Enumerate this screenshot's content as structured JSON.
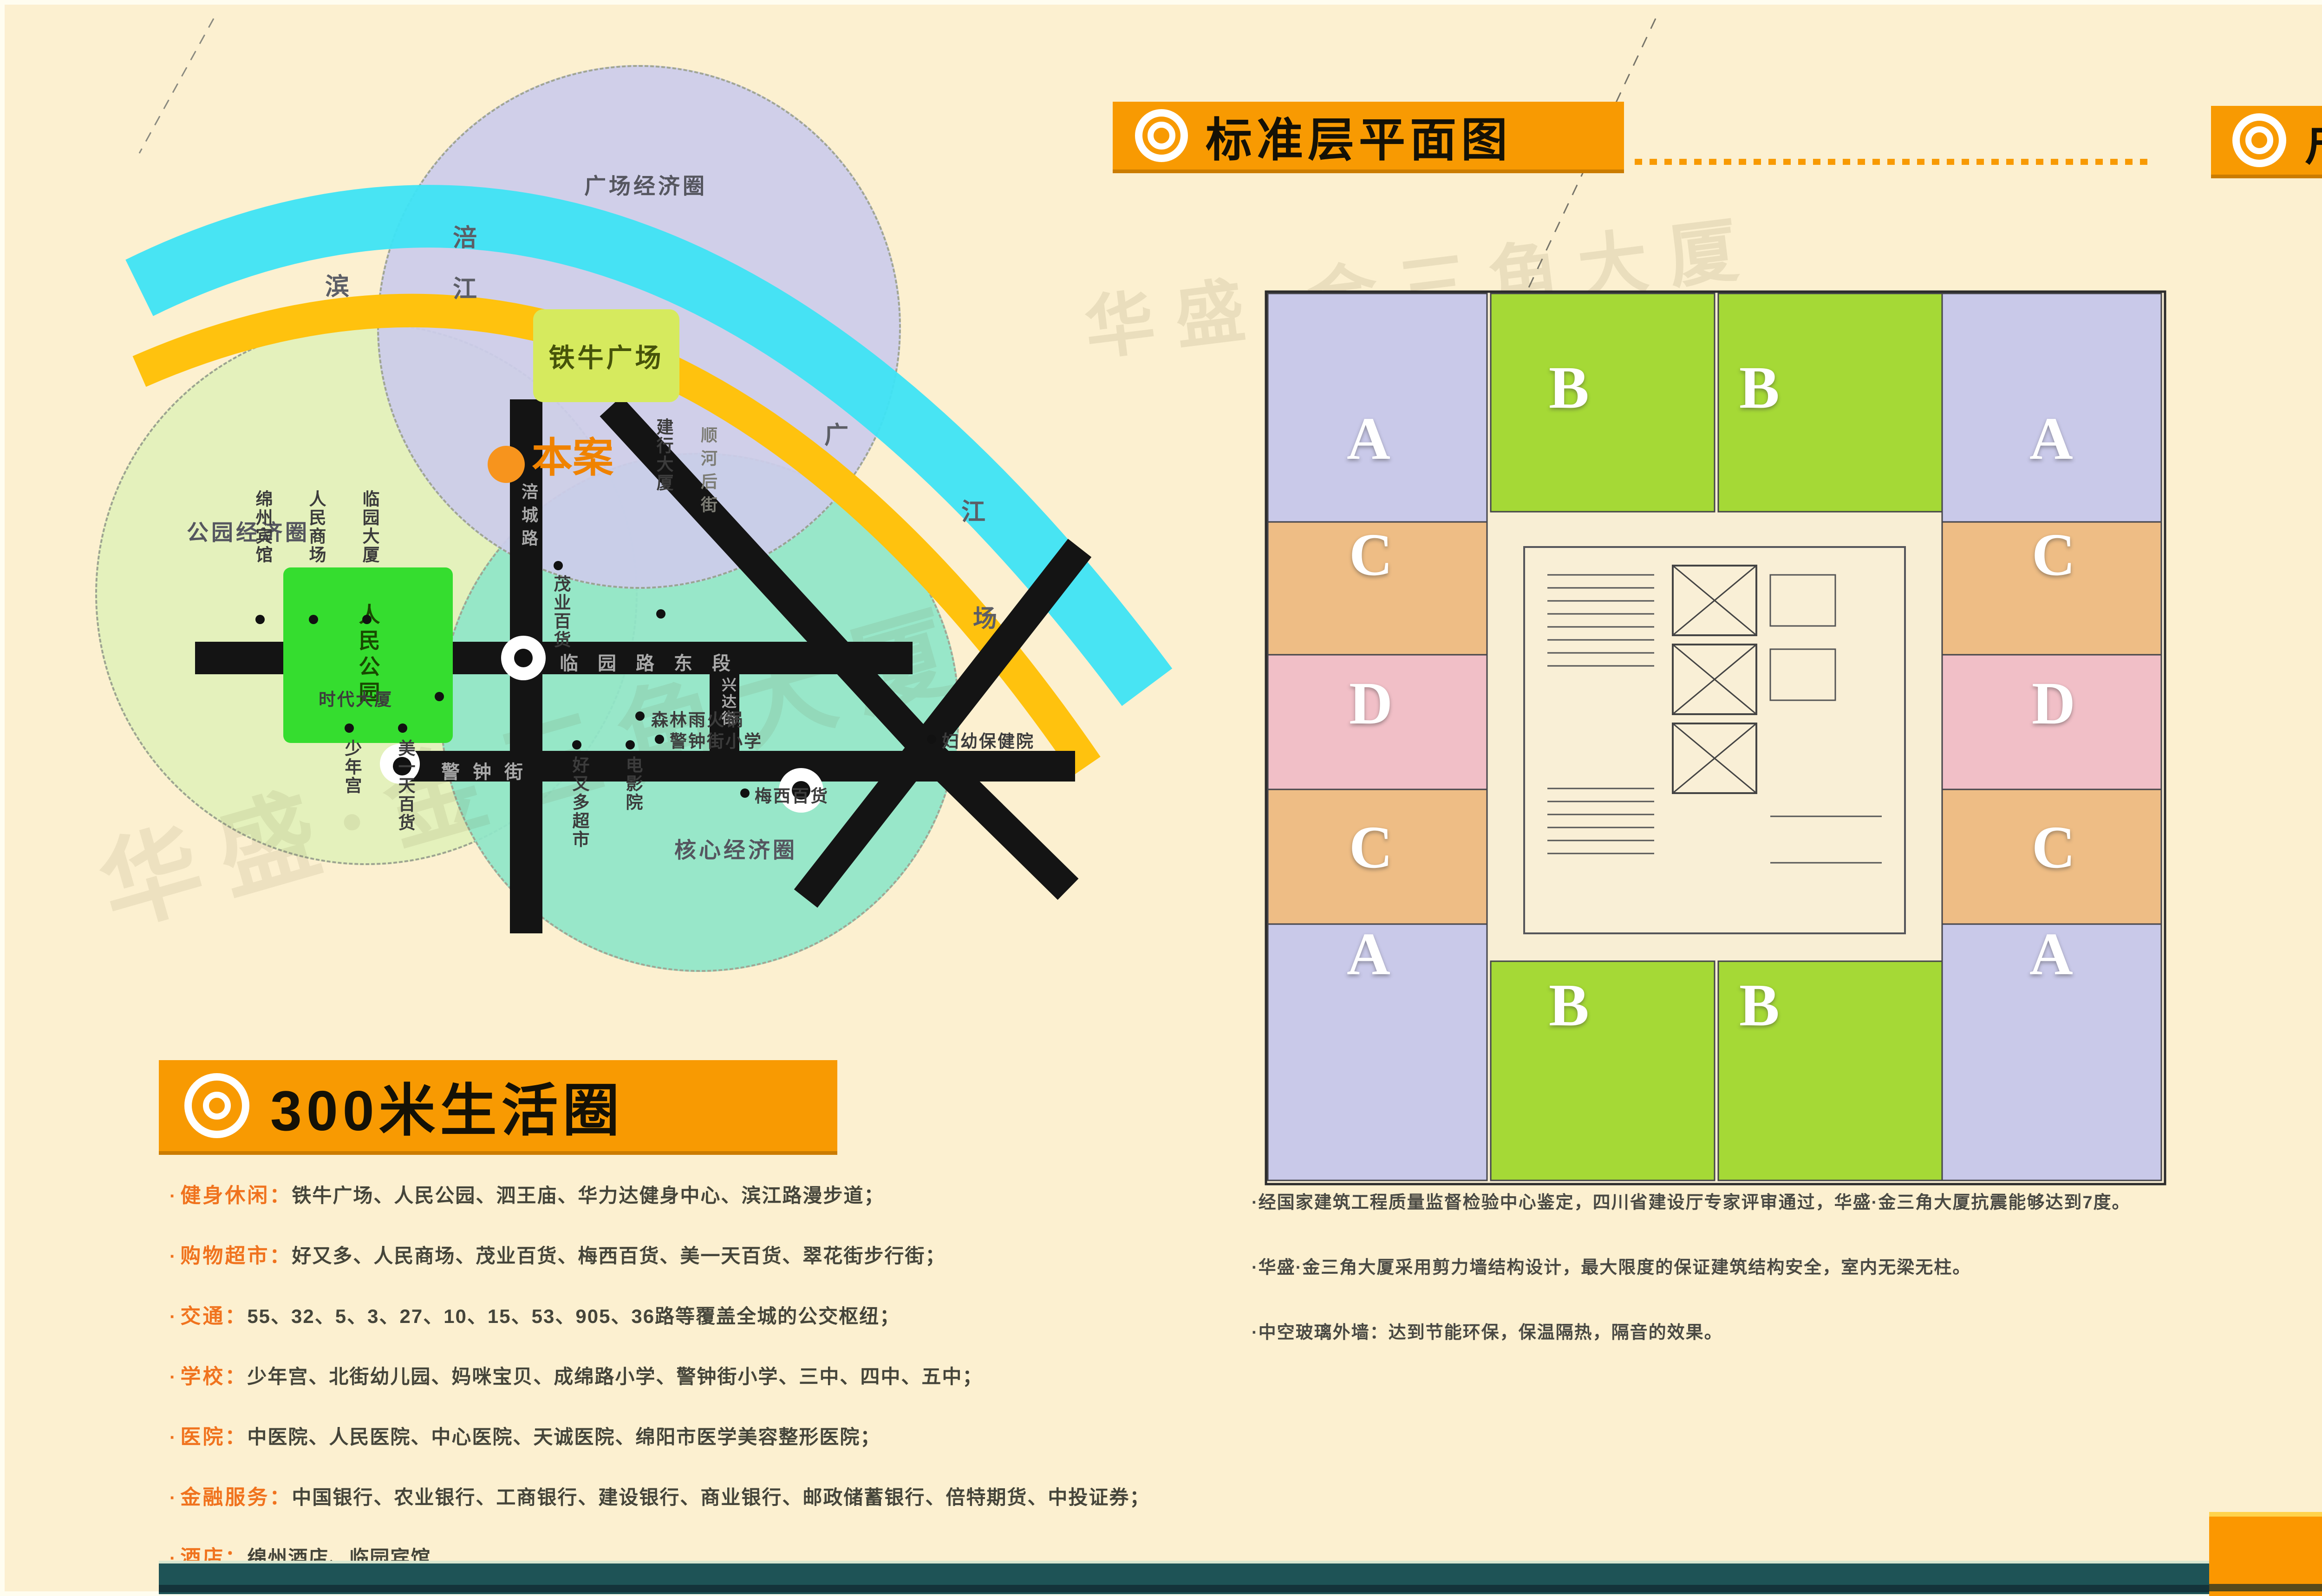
{
  "page": {
    "background": "#fcf0d0",
    "frame": "#fffdf0",
    "accent_orange": "#f89a02",
    "teal_bar": "#1e5356",
    "orange_bar": "#fb9700"
  },
  "watermark": {
    "text": "华盛·金三角大厦"
  },
  "map": {
    "circles": [
      {
        "label": "广场经济圈",
        "color": "#cdcdeb"
      },
      {
        "label": "公园经济圈",
        "color": "#e4f2bc"
      },
      {
        "label": "核心经济圈",
        "color": "#90e7c9"
      }
    ],
    "river_color": "#3ee3f4",
    "riverside_color": "#ffc20e",
    "band_chars": [
      {
        "ch": "涪"
      },
      {
        "ch": "江"
      },
      {
        "ch": "滨"
      },
      {
        "ch": "广"
      },
      {
        "ch": "江"
      },
      {
        "ch": "场"
      }
    ],
    "plaza": "铁牛广场",
    "site": "本案",
    "park": "人民公园",
    "roads": {
      "linyuan": "临园路东段",
      "fucheng": "涪城路",
      "jingzhong": "警钟街",
      "xingda": "兴达街",
      "shunhe": "顺河后街"
    },
    "pois": [
      {
        "label": "绵州宾馆"
      },
      {
        "label": "人民商场"
      },
      {
        "label": "临园大厦"
      },
      {
        "label": "建行大厦"
      },
      {
        "label": "森林雨火锅"
      },
      {
        "label": "时代大厦"
      },
      {
        "label": "少年宫"
      },
      {
        "label": "美一天百货"
      },
      {
        "label": "好又多超市"
      },
      {
        "label": "电影院"
      },
      {
        "label": "茂业百货"
      },
      {
        "label": "梅西百货"
      },
      {
        "label": "警钟街小学"
      },
      {
        "label": "妇幼保健院"
      }
    ]
  },
  "life_circle": {
    "title": "300米生活圈",
    "bullet": "·",
    "categories": [
      {
        "label": "健身休闲：",
        "items": "铁牛广场、人民公园、泗王庙、华力达健身中心、滨江路漫步道；"
      },
      {
        "label": "购物超市：",
        "items": "好又多、人民商场、茂业百货、梅西百货、美一天百货、翠花街步行街；"
      },
      {
        "label": "交通：",
        "items": "55、32、5、3、27、10、15、53、905、36路等覆盖全城的公交枢纽；"
      },
      {
        "label": "学校：",
        "items": "少年宫、北街幼儿园、妈咪宝贝、成绵路小学、警钟街小学、三中、四中、五中；"
      },
      {
        "label": "医院：",
        "items": "中医院、人民医院、中心医院、天诚医院、绵阳市医学美容整形医院；"
      },
      {
        "label": "金融服务：",
        "items": "中国银行、农业银行、工商银行、建设银行、商业银行、邮政储蓄银行、倍特期货、中投证券；"
      },
      {
        "label": "酒店：",
        "items": "绵州酒店、临园宾馆"
      }
    ]
  },
  "floorplan": {
    "title": "标准层平面图",
    "letters": {
      "a": "A",
      "b": "B",
      "c": "C",
      "d": "D"
    },
    "unit_colors": {
      "a": "#c9c9e9",
      "b": "#a5d936",
      "c": "#eebd85",
      "d": "#f1bfc7"
    },
    "notes": [
      {
        "text": "·经国家建筑工程质量监督检验中心鉴定，四川省建设厅专家评审通过，华盛·金三角大厦抗震能够达到7度。"
      },
      {
        "text": "·华盛·金三角大厦采用剪力墙结构设计，最大限度的保证建筑结构安全，室内无梁无柱。"
      },
      {
        "text": "·中空玻璃外墙：达到节能环保，保温隔热，隔音的效果。"
      }
    ]
  },
  "huxing": {
    "title": "户型赏析",
    "units": [
      {
        "letter": "A",
        "suffix": "户型",
        "area": "建筑面积：约112㎡",
        "bullets": [
          {
            "text": "·客厅、餐厅独立但又自然贯通，大方而氛围温馨；"
          },
          {
            "text": "·厨房、卫生间紧邻大开窗，采光充足；"
          },
          {
            "text": "·户型方正，科学划分动静区，实现生活完美容纳；"
          }
        ],
        "dims_top": [
          "1800",
          "3900",
          "3300"
        ],
        "dims_left": [
          "2100",
          "1500",
          "600",
          "2700",
          "1500"
        ],
        "rooms": [
          "卧室",
          "卧室",
          "客厅",
          "餐厅",
          "厨房",
          "卫生间"
        ]
      },
      {
        "letter": "B",
        "suffix": "户型",
        "area": "建筑面积：约98.5㎡",
        "bullets": [
          {
            "text": "·动静分区、干湿分区，完全的人性化设计，尤显居家品质；"
          },
          {
            "text": "·独立洗漱间的考虑科学而时尚，方便而适用；"
          },
          {
            "text": "·厨房空间实用大方，并配备生活阳台，充分满足居家所需；"
          }
        ],
        "dims_top": [
          "600",
          "3300",
          "3450"
        ],
        "dims_left": [
          "2100",
          "5400",
          "1800",
          "2100"
        ],
        "dims_right": [
          "4200",
          "3300"
        ],
        "rooms": [
          "餐厅",
          "卧室",
          "客厅",
          "厨房"
        ]
      }
    ]
  }
}
